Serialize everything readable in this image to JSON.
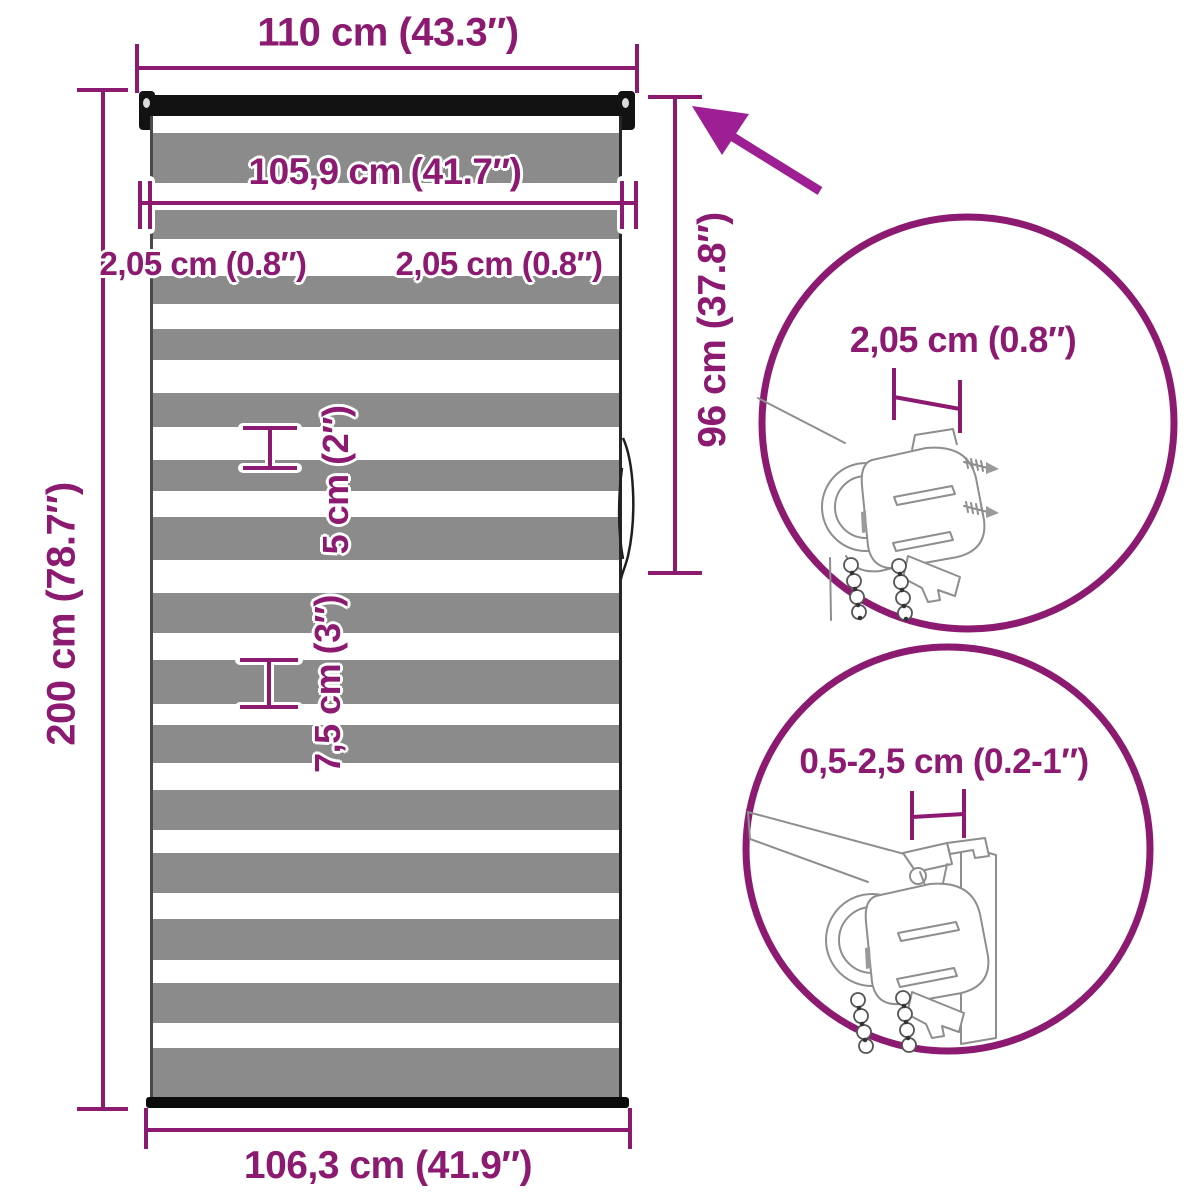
{
  "colors": {
    "accent": "#8B1A70",
    "arrow": "#9E1F93",
    "art_stroke": "#8E8E8E",
    "blind_black": "#121212",
    "stripe_gray": "#8B8B8B",
    "stripe_white": "#FFFFFF"
  },
  "labels": {
    "width_top": "110 cm (43.3″)",
    "fabric_width": "105,9 cm (41.7″)",
    "gap_left": "2,05 cm (0.8″)",
    "gap_right": "2,05 cm (0.8″)",
    "stripe_small": "5 cm (2″)",
    "stripe_large": "7,5 cm (3″)",
    "height_total": "200 cm (78.7″)",
    "height_roll": "96 cm (37.8″)",
    "width_bottom": "106,3 cm (41.9″)",
    "detail_top": "2,05 cm (0.8″)",
    "detail_bottom": "0,5-2,5 cm (0.2-1″)"
  },
  "blind": {
    "stripes": [
      {
        "h": 17,
        "c": "w"
      },
      {
        "h": 50,
        "c": "g"
      },
      {
        "h": 27,
        "c": "w"
      },
      {
        "h": 29,
        "c": "g"
      },
      {
        "h": 37,
        "c": "w"
      },
      {
        "h": 28,
        "c": "g"
      },
      {
        "h": 25,
        "c": "w"
      },
      {
        "h": 31,
        "c": "g"
      },
      {
        "h": 33,
        "c": "w"
      },
      {
        "h": 34,
        "c": "g"
      },
      {
        "h": 33,
        "c": "w"
      },
      {
        "h": 31,
        "c": "g"
      },
      {
        "h": 26,
        "c": "w"
      },
      {
        "h": 43,
        "c": "g"
      },
      {
        "h": 33,
        "c": "w"
      },
      {
        "h": 40,
        "c": "g"
      },
      {
        "h": 27,
        "c": "w"
      },
      {
        "h": 44,
        "c": "g"
      },
      {
        "h": 21,
        "c": "w"
      },
      {
        "h": 38,
        "c": "g"
      },
      {
        "h": 27,
        "c": "w"
      },
      {
        "h": 40,
        "c": "g"
      },
      {
        "h": 23,
        "c": "w"
      },
      {
        "h": 40,
        "c": "g"
      },
      {
        "h": 26,
        "c": "w"
      },
      {
        "h": 41,
        "c": "g"
      },
      {
        "h": 23,
        "c": "w"
      },
      {
        "h": 40,
        "c": "g"
      },
      {
        "h": 25,
        "c": "w"
      },
      {
        "h": 49,
        "c": "g"
      }
    ]
  }
}
